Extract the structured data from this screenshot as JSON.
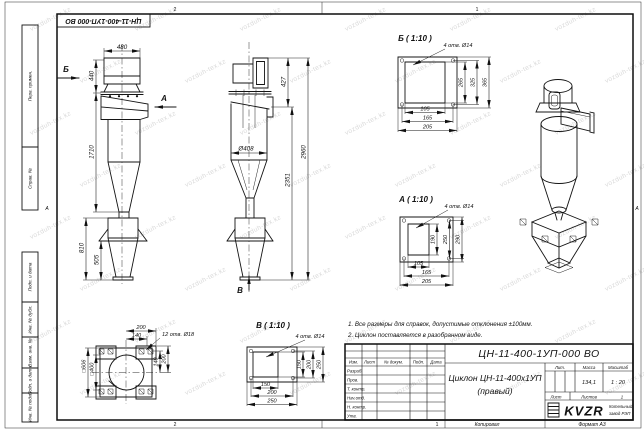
{
  "meta": {
    "format": "Формат А3",
    "copied": "Копировал",
    "zones_top": [
      "2",
      "1"
    ],
    "zones_bottom": [
      "2",
      "1"
    ],
    "zone_side": "А"
  },
  "watermark": {
    "text": "vozduh-tex.kz"
  },
  "designation_stamp": "ЦН-11-400-1УП-000 ВО",
  "side_column": {
    "perv_primen": "Перв. примен.",
    "sprav_no": "Справ. №",
    "podp_data1": "Подп. и дата",
    "inv_dubl": "Инв. № дубл.",
    "vzam_inv": "Взам. инв. №",
    "podp_data2": "Подп. и дата",
    "inv_podl": "Инв. № подл."
  },
  "notes": {
    "line1": "1. Все размеры для справок, допустимые отклонения ±100мм.",
    "line2": "2. Циклон поставляется в разобранном виде."
  },
  "views": {
    "front": {
      "dim_width_top": "480",
      "dim_inlet_height": "440",
      "dim_body_height": "1710",
      "dim_bunker_height": "810",
      "dim_hopper_height": "505",
      "arrow_left": "Б",
      "arrow_right": "А"
    },
    "side": {
      "dim_outlet_height": "427",
      "dim_total_height": "2960",
      "dim_lower_height": "2351",
      "dim_diameter": "Ø408",
      "arrow_bottom": "В"
    },
    "detail_b": {
      "title": "Б ( 1:10 )",
      "holes_note": "4 отв. Ø14",
      "dims_vertical": [
        "265",
        "325",
        "365"
      ],
      "dims_horizontal": [
        "105",
        "165",
        "205"
      ]
    },
    "detail_a": {
      "title": "А ( 1:10 )",
      "holes_note": "4 отв. Ø14",
      "dims_vertical": [
        "190",
        "250",
        "290"
      ],
      "dims_horizontal": [
        "105",
        "165",
        "205"
      ]
    },
    "detail_v": {
      "title": "В ( 1:10 )",
      "holes_note": "4 отв. Ø14",
      "dims_vertical": [
        "150",
        "200",
        "250"
      ],
      "dims_horizontal": [
        "150",
        "200",
        "250"
      ]
    },
    "flange_view": {
      "holes_note": "12 отв. Ø18",
      "dim_top_1": "200",
      "dim_top_2": "140",
      "dim_right_1": "140",
      "dim_right_2": "200",
      "dim_left_outer": "□606",
      "dim_left_inner": "□400"
    }
  },
  "title_block": {
    "designation": "ЦН-11-400-1УП-000 ВО",
    "name_line1": "Циклон ЦН-11-400х1УП",
    "name_line2": "(правый)",
    "header_cols": [
      "Изм.",
      "Лист",
      "№ докум.",
      "Подп.",
      "Дата"
    ],
    "rows": [
      "Разраб.",
      "Пров.",
      "Т. контр.",
      "Нач.отд.",
      "Н. контр.",
      "Утв."
    ],
    "lit_label": "Лит.",
    "mass_label": "Масса",
    "scale_label": "Масштаб",
    "mass_value": "134,1",
    "scale_value": "1 : 20",
    "sheet_label": "Лист",
    "sheets_label": "Листов",
    "sheets_value": "1",
    "logo_text": "KVZR",
    "company_line1": "Котельный",
    "company_line2": "завод РЭП"
  }
}
